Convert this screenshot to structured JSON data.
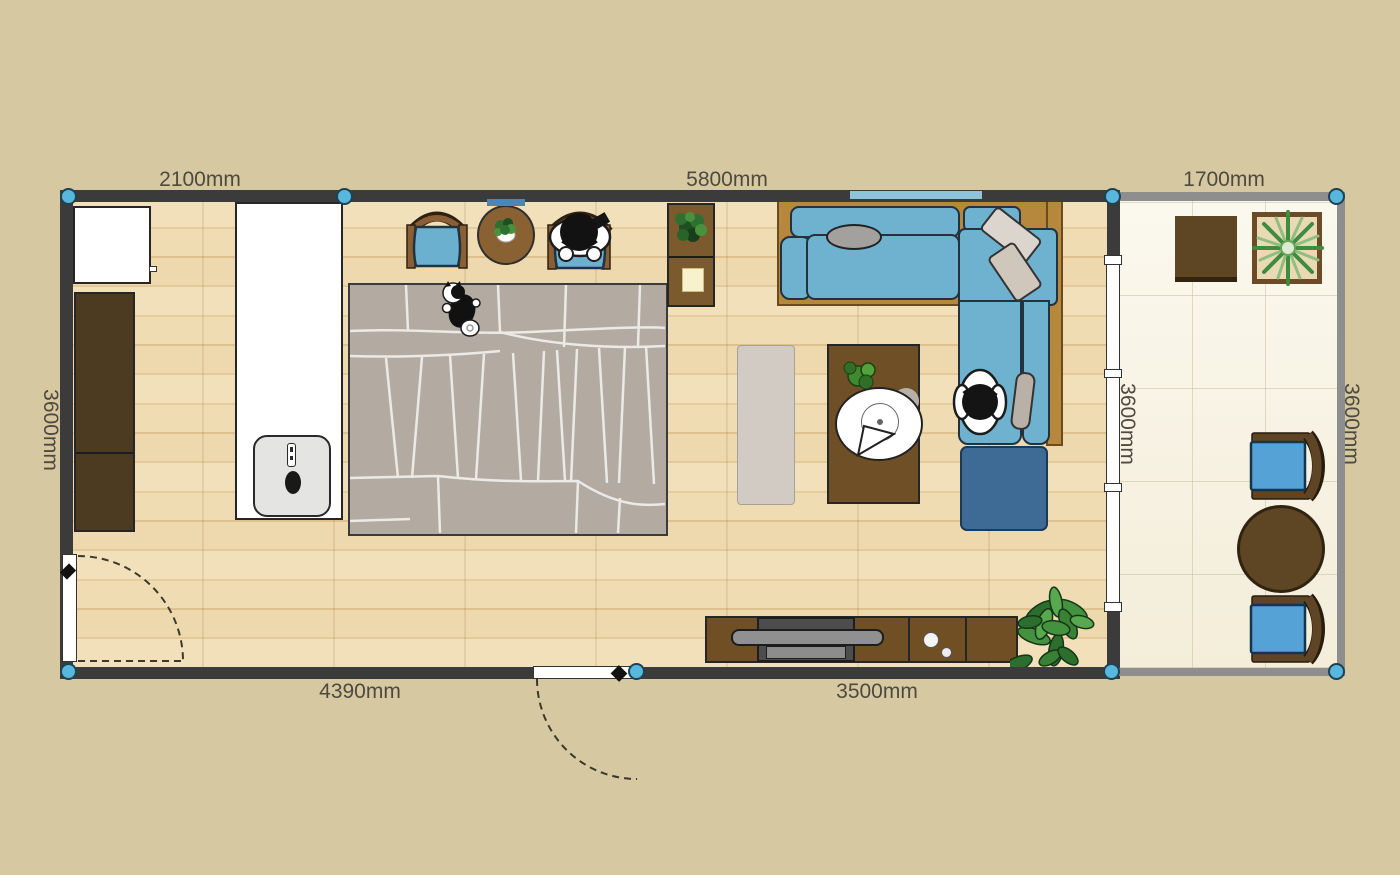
{
  "canvas": {
    "width": 1400,
    "height": 875,
    "background": "#d6c8a1"
  },
  "dimension_labels": {
    "top_left": "2100mm",
    "top_middle": "5800mm",
    "balcony_top": "1700mm",
    "left": "3600mm",
    "balcony_inner": "3600mm",
    "balcony_right": "3600mm",
    "bottom_left": "4390mm",
    "bottom_middle": "3500mm"
  },
  "colors": {
    "background": "#d6c8a1",
    "wall_main": "#3b3b3b",
    "wall_balcony": "#8e8e8e",
    "corner_handle_blue": "#57b7dc",
    "floor_wood": "#ecd7ab",
    "floor_balcony": "#f9f5e9",
    "sofa_blue": "#6fb2d0",
    "balcony_chair_blue": "#55a3d6",
    "ottoman_blue": "#3d6b95",
    "rug_gray": "#b3aaa2",
    "console_brown": "#6f4f23",
    "wardrobe_brown": "#4c3a21",
    "sofa_frame_wood": "#b5883e",
    "plant_green": "#3f8f3f",
    "dimension_text": "#4e4a40"
  },
  "furniture": [
    "appliance-cabinet",
    "wardrobe",
    "kitchen-counter",
    "sink",
    "dining-chair",
    "round-dining-table",
    "dining-chair-occupied",
    "person",
    "side-cabinet",
    "table-lamp",
    "area-rug",
    "cat",
    "bench",
    "coffee-table",
    "sectional-sofa",
    "throw-pillow",
    "person-on-sofa",
    "ottoman",
    "tv-console",
    "tv",
    "floor-plant",
    "potted-plant",
    "balcony-square-table",
    "balcony-planter",
    "balcony-chair",
    "balcony-round-table",
    "entry-door",
    "terrace-door",
    "sliding-glass-door",
    "window"
  ]
}
